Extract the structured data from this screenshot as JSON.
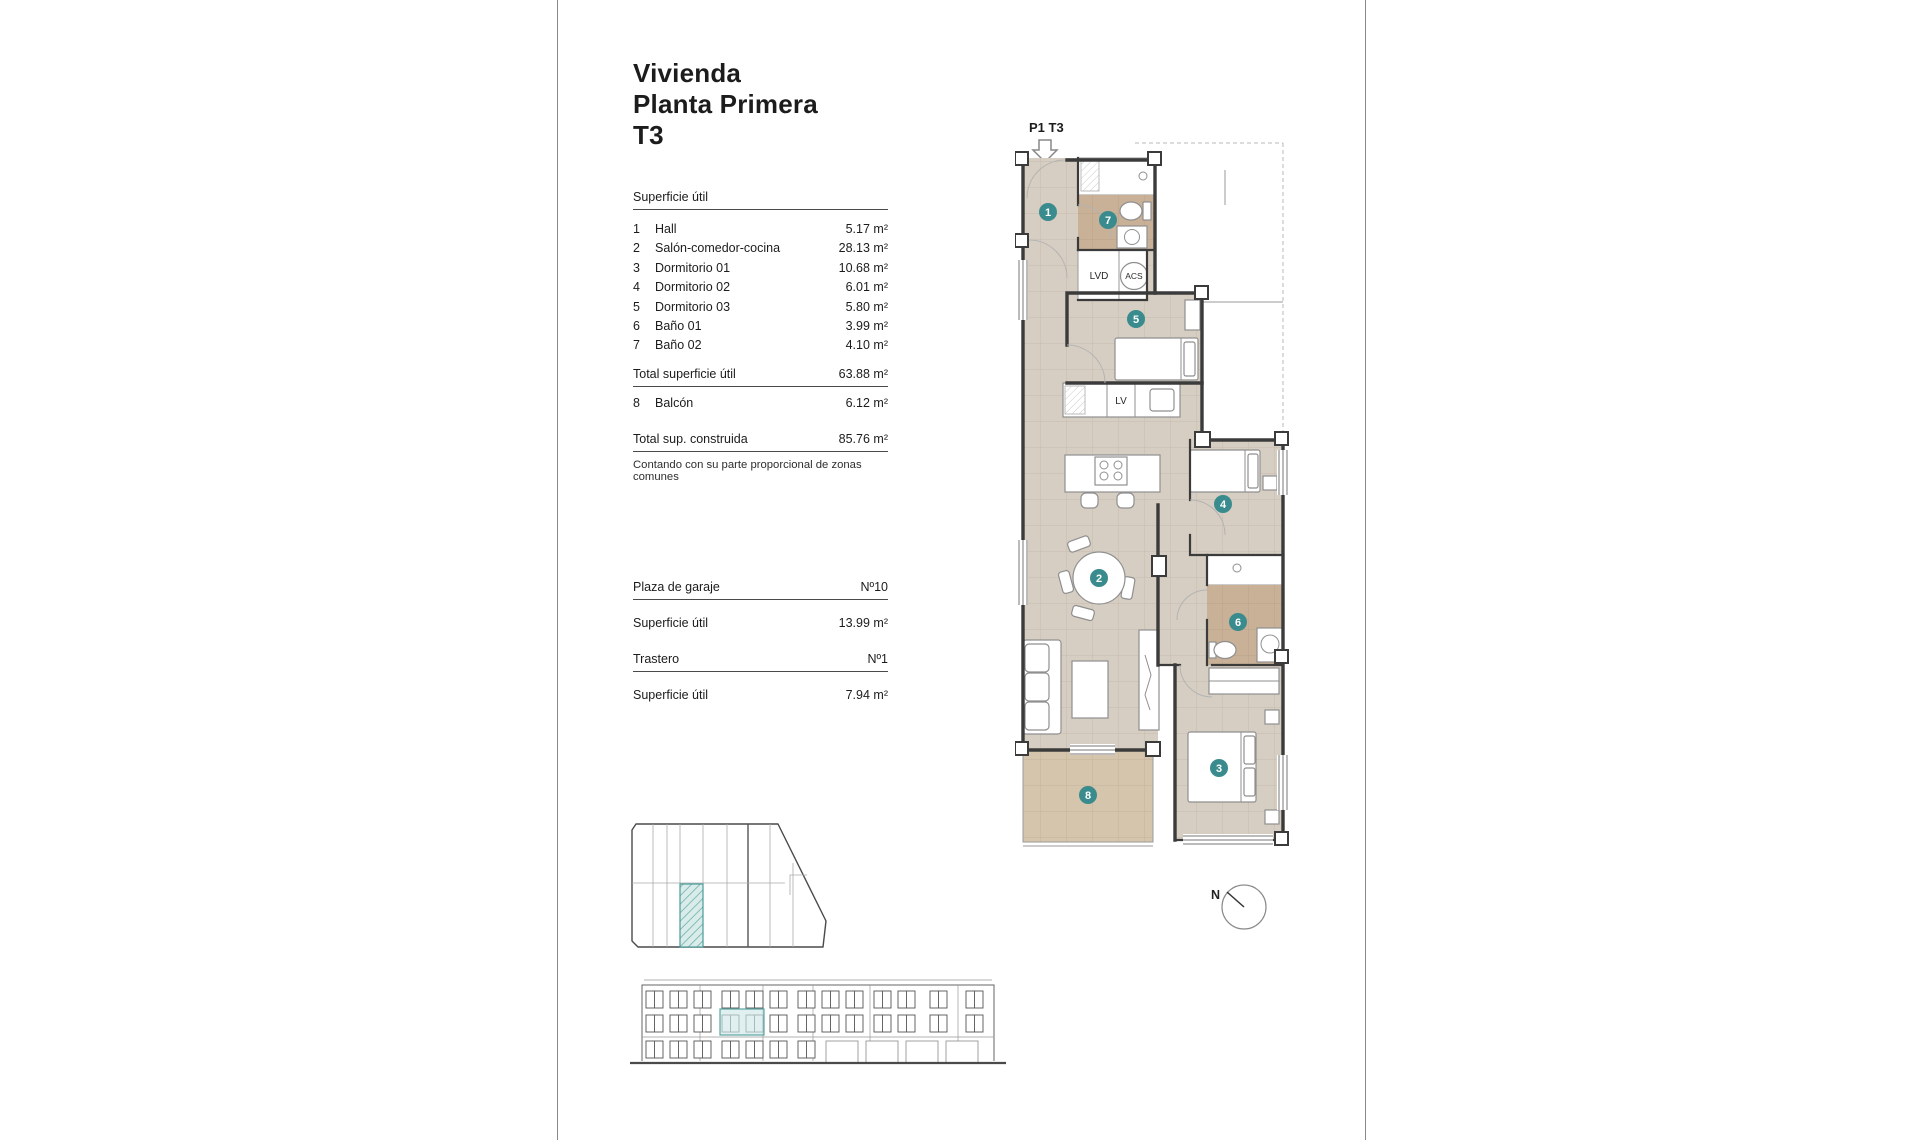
{
  "title": {
    "line1": "Vivienda",
    "line2": "Planta Primera",
    "line3": "T3"
  },
  "surface": {
    "header": "Superficie útil",
    "rows": [
      {
        "num": "1",
        "name": "Hall",
        "value": "5.17 m²"
      },
      {
        "num": "2",
        "name": "Salón-comedor-cocina",
        "value": "28.13 m²"
      },
      {
        "num": "3",
        "name": "Dormitorio 01",
        "value": "10.68 m²"
      },
      {
        "num": "4",
        "name": "Dormitorio 02",
        "value": "6.01 m²"
      },
      {
        "num": "5",
        "name": "Dormitorio 03",
        "value": "5.80 m²"
      },
      {
        "num": "6",
        "name": "Baño 01",
        "value": "3.99 m²"
      },
      {
        "num": "7",
        "name": "Baño 02",
        "value": "4.10 m²"
      }
    ],
    "total_label": "Total superficie útil",
    "total_value": "63.88 m²",
    "balcony": {
      "num": "8",
      "name": "Balcón",
      "value": "6.12 m²"
    },
    "built_label": "Total sup. construida",
    "built_value": "85.76 m²",
    "note": "Contando con su parte proporcional de zonas comunes"
  },
  "garage": {
    "label": "Plaza de garaje",
    "number": "Nº10",
    "area_label": "Superficie útil",
    "area_value": "13.99 m²"
  },
  "storage": {
    "label": "Trastero",
    "number": "Nº1",
    "area_label": "Superficie útil",
    "area_value": "7.94 m²"
  },
  "plan": {
    "unit_label": "P1 T3",
    "badges": [
      "1",
      "2",
      "3",
      "4",
      "5",
      "6",
      "7",
      "8"
    ],
    "labels": {
      "lvd": "LVD",
      "acs": "ACS",
      "lv": "LV"
    },
    "compass": "N",
    "colors": {
      "floor": "#d6cec2",
      "bathroom": "#c9b197",
      "balcony": "#d5c5ac",
      "badge": "#3a8b8d",
      "wall": "#3b3b3b",
      "highlight": "#cfe7e6",
      "highlight_stroke": "#5aa5a2"
    }
  }
}
